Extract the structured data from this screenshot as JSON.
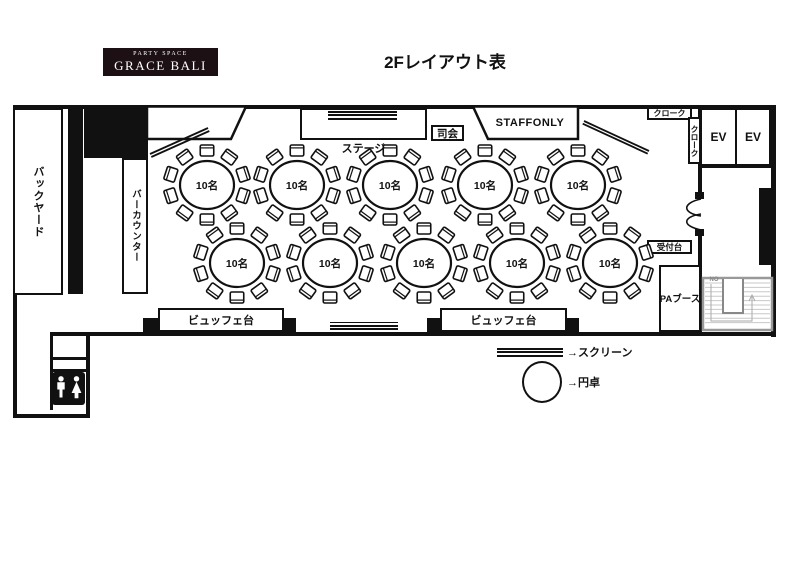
{
  "page": {
    "title": "2Fレイアウト表"
  },
  "brand": {
    "tagline": "PARTY SPACE",
    "name": "GRACE BALI"
  },
  "plan": {
    "rooms": {
      "backyard": "バックヤード",
      "bar_counter": "バーカウンター",
      "stage": "ステージ",
      "mc": "司会",
      "staff_only": "STAFFONLY",
      "cloak_top": "クローク",
      "cloak_side": "クローク",
      "ev_left": "EV",
      "ev_right": "EV",
      "reception": "受付台",
      "pa_booth": "PAブース",
      "stairs_note": "NO"
    },
    "tables": {
      "seat_label": "10名",
      "count": 10
    },
    "buffets": [
      {
        "label": "ビュッフェ台"
      },
      {
        "label": "ビュッフェ台"
      }
    ],
    "legend": {
      "screen_label": "→スクリーン",
      "round_table_label": "→円卓"
    }
  },
  "colors": {
    "ink": "#111111",
    "stair_gray": "#999999"
  }
}
